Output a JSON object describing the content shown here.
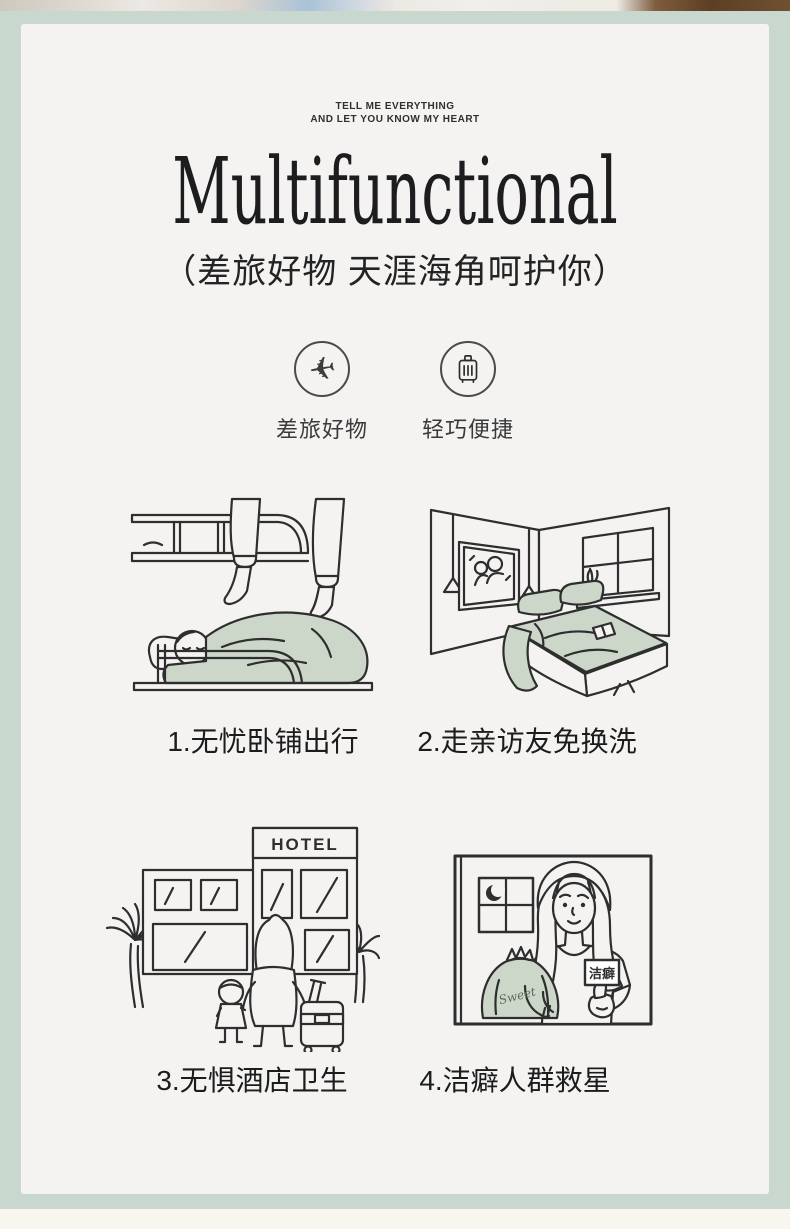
{
  "colors": {
    "border_green": "#c9d8ce",
    "panel_bg": "#f4f3f2",
    "illustration_sage": "#ccd7ca",
    "line": "#2e2e2e"
  },
  "header": {
    "tagline_line1": "TELL ME EVERYTHING",
    "tagline_line2": "AND LET YOU KNOW MY HEART",
    "title": "Multifunctional",
    "subtitle": "（差旅好物 天涯海角呵护你）"
  },
  "features": [
    {
      "icon": "airplane-icon",
      "glyph": "✈",
      "label": "差旅好物"
    },
    {
      "icon": "suitcase-icon",
      "label": "轻巧便捷"
    }
  ],
  "scenes": [
    {
      "caption": "1.无忧卧铺出行"
    },
    {
      "caption": "2.走亲访友免换洗"
    },
    {
      "caption": "3.无惧酒店卫生",
      "sign_text": "HOTEL"
    },
    {
      "caption": "4.洁癖人群救星",
      "badge_text": "洁癖",
      "bag_text": "Sweet"
    }
  ]
}
